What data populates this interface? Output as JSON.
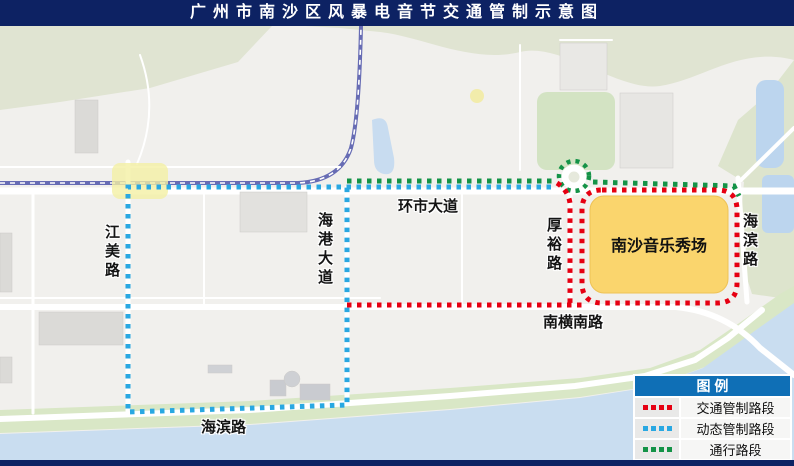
{
  "title": "广州市南沙区风暴电音节交通管制示意图",
  "map": {
    "venue": {
      "label": "南沙音乐秀场"
    },
    "roads": {
      "jiangmei": "江美路",
      "haigang": "海港大道",
      "huanshi": "环市大道",
      "houyu": "厚裕路",
      "haibin_right": "海滨路",
      "nanheng": "南横南路",
      "haibin_bottom": "海滨路"
    }
  },
  "legend": {
    "header": "图 例",
    "items": [
      {
        "name": "traffic-control",
        "label": "交通管制路段",
        "color": "#e60012",
        "swatch_style": "color:#e60012"
      },
      {
        "name": "dynamic-control",
        "label": "动态管制路段",
        "color": "#29a8e2",
        "swatch_style": "color:#29a8e2"
      },
      {
        "name": "open-road",
        "label": "通行路段",
        "color": "#149347",
        "swatch_style": "color:#149347"
      }
    ]
  },
  "colors": {
    "title_bar": "#0d2263",
    "legend_header": "#0f6fb6",
    "traffic_control": "#e60012",
    "dynamic_control": "#29a8e2",
    "open_road": "#149347",
    "venue_fill": "#fad56d"
  }
}
